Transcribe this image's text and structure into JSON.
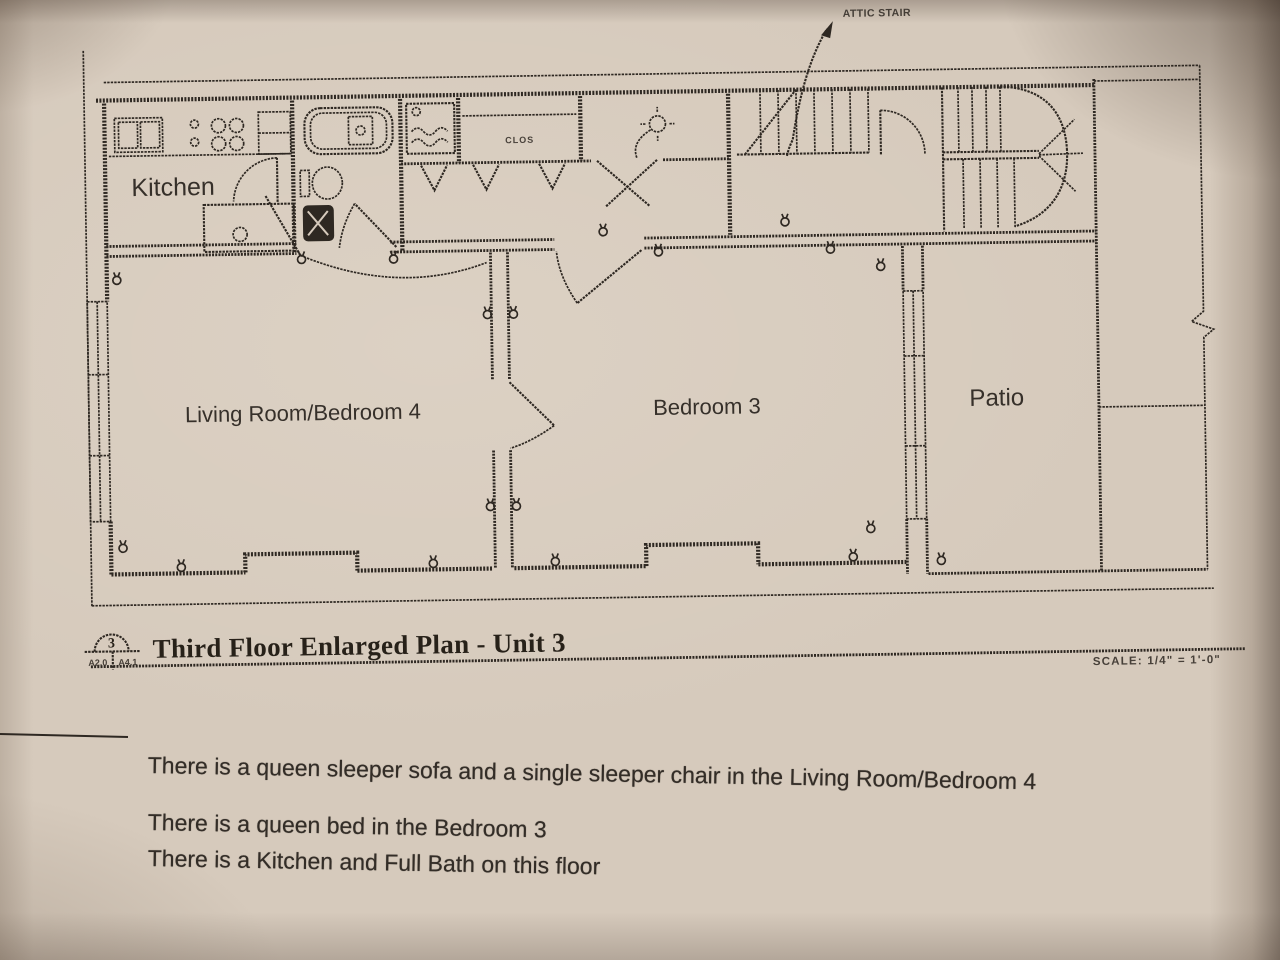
{
  "photo": {
    "paper_color": "#d6cabc",
    "ink_color": "#2e2822"
  },
  "plan": {
    "labels": {
      "kitchen": "Kitchen",
      "living_room": "Living Room/Bedroom 4",
      "bedroom3": "Bedroom 3",
      "patio": "Patio",
      "closet": "CLOS",
      "attic_stair": "ATTIC STAIR"
    },
    "title_block": {
      "callout_number": "3",
      "callout_ref_left": "A2.0",
      "callout_ref_right": "A4.1",
      "title": "Third Floor Enlarged Plan - Unit 3",
      "scale": "SCALE: 1/4\" = 1'-0\""
    }
  },
  "notes": {
    "lines": [
      "There is a queen sleeper sofa and a single sleeper chair in the Living Room/Bedroom 4",
      "There is a queen bed in the Bedroom 3",
      "There is a Kitchen and Full Bath on this floor"
    ]
  }
}
